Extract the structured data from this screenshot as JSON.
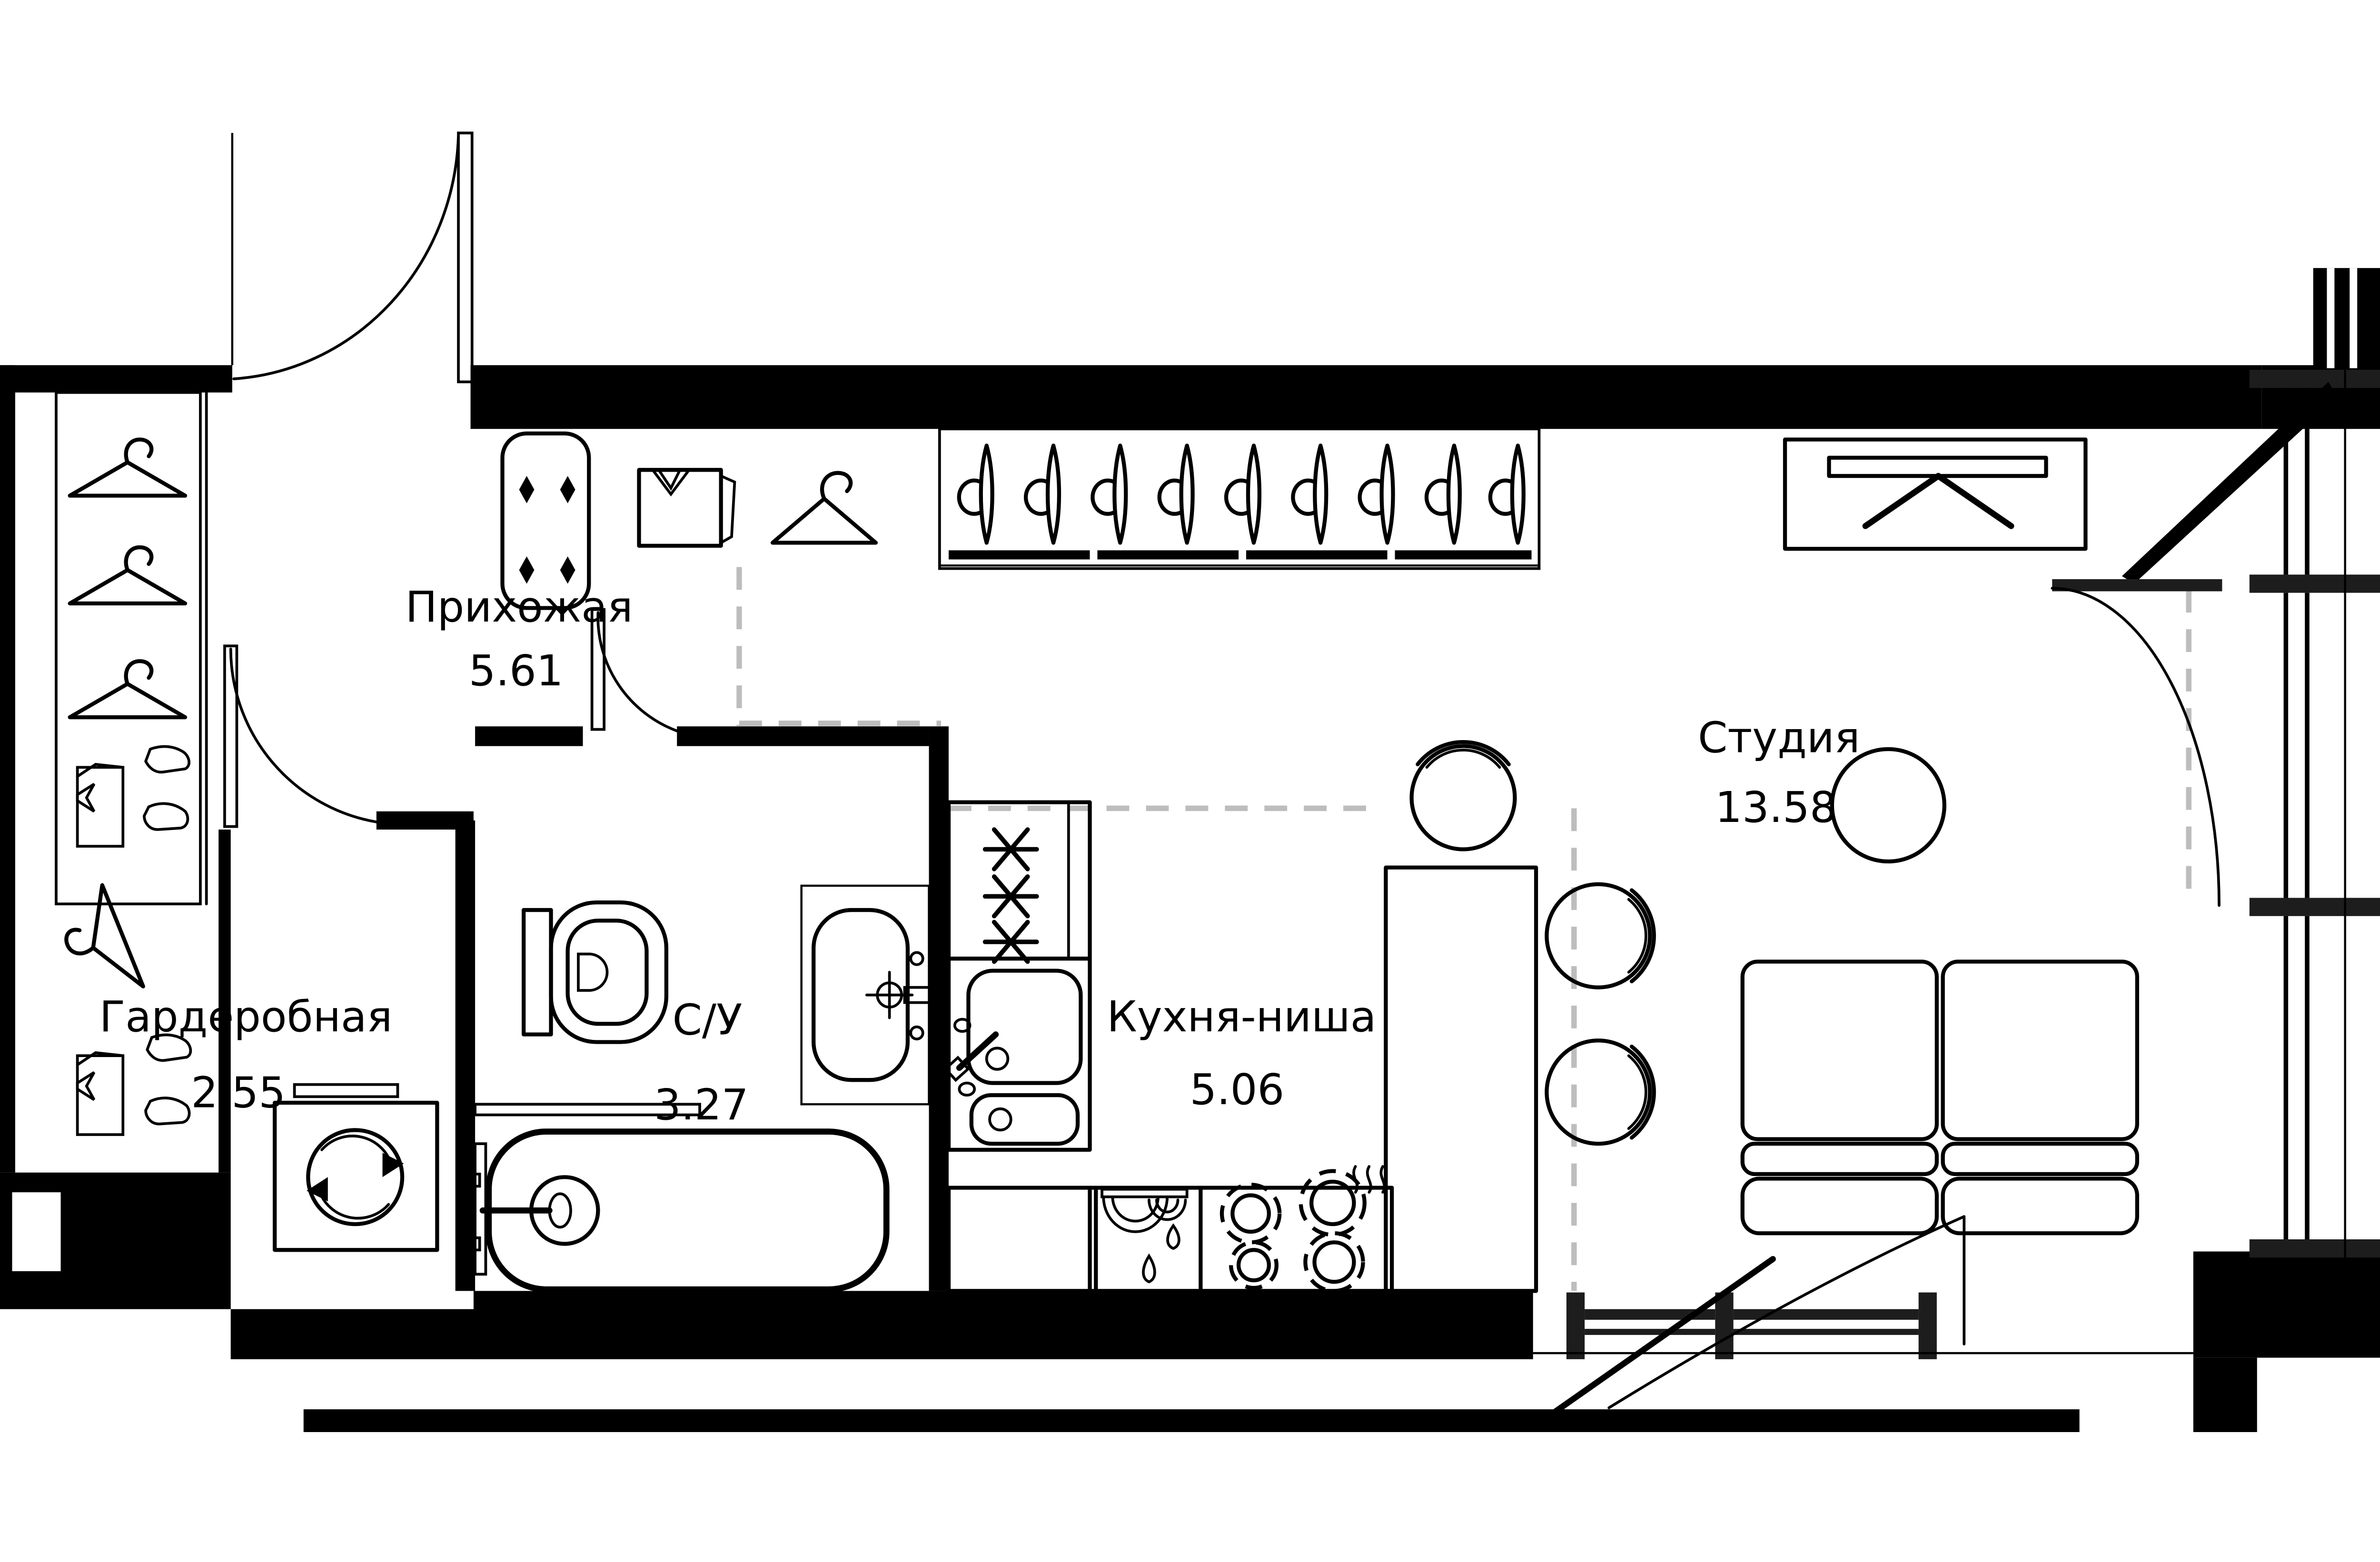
{
  "plan": {
    "title": "Studio apartment floor plan",
    "rooms": [
      {
        "name": "Прихожая",
        "area": "5.61"
      },
      {
        "name": "Гардеробная",
        "area": "2.55"
      },
      {
        "name": "С/У",
        "area": "3.27"
      },
      {
        "name": "Кухня-ниша",
        "area": "5.06"
      },
      {
        "name": "Студия",
        "area": "13.58"
      }
    ],
    "colors": {
      "walls": "#000000",
      "lines": "#000000",
      "zone_boundary_dash": "#bdbdbd",
      "background": "#ffffff"
    }
  }
}
